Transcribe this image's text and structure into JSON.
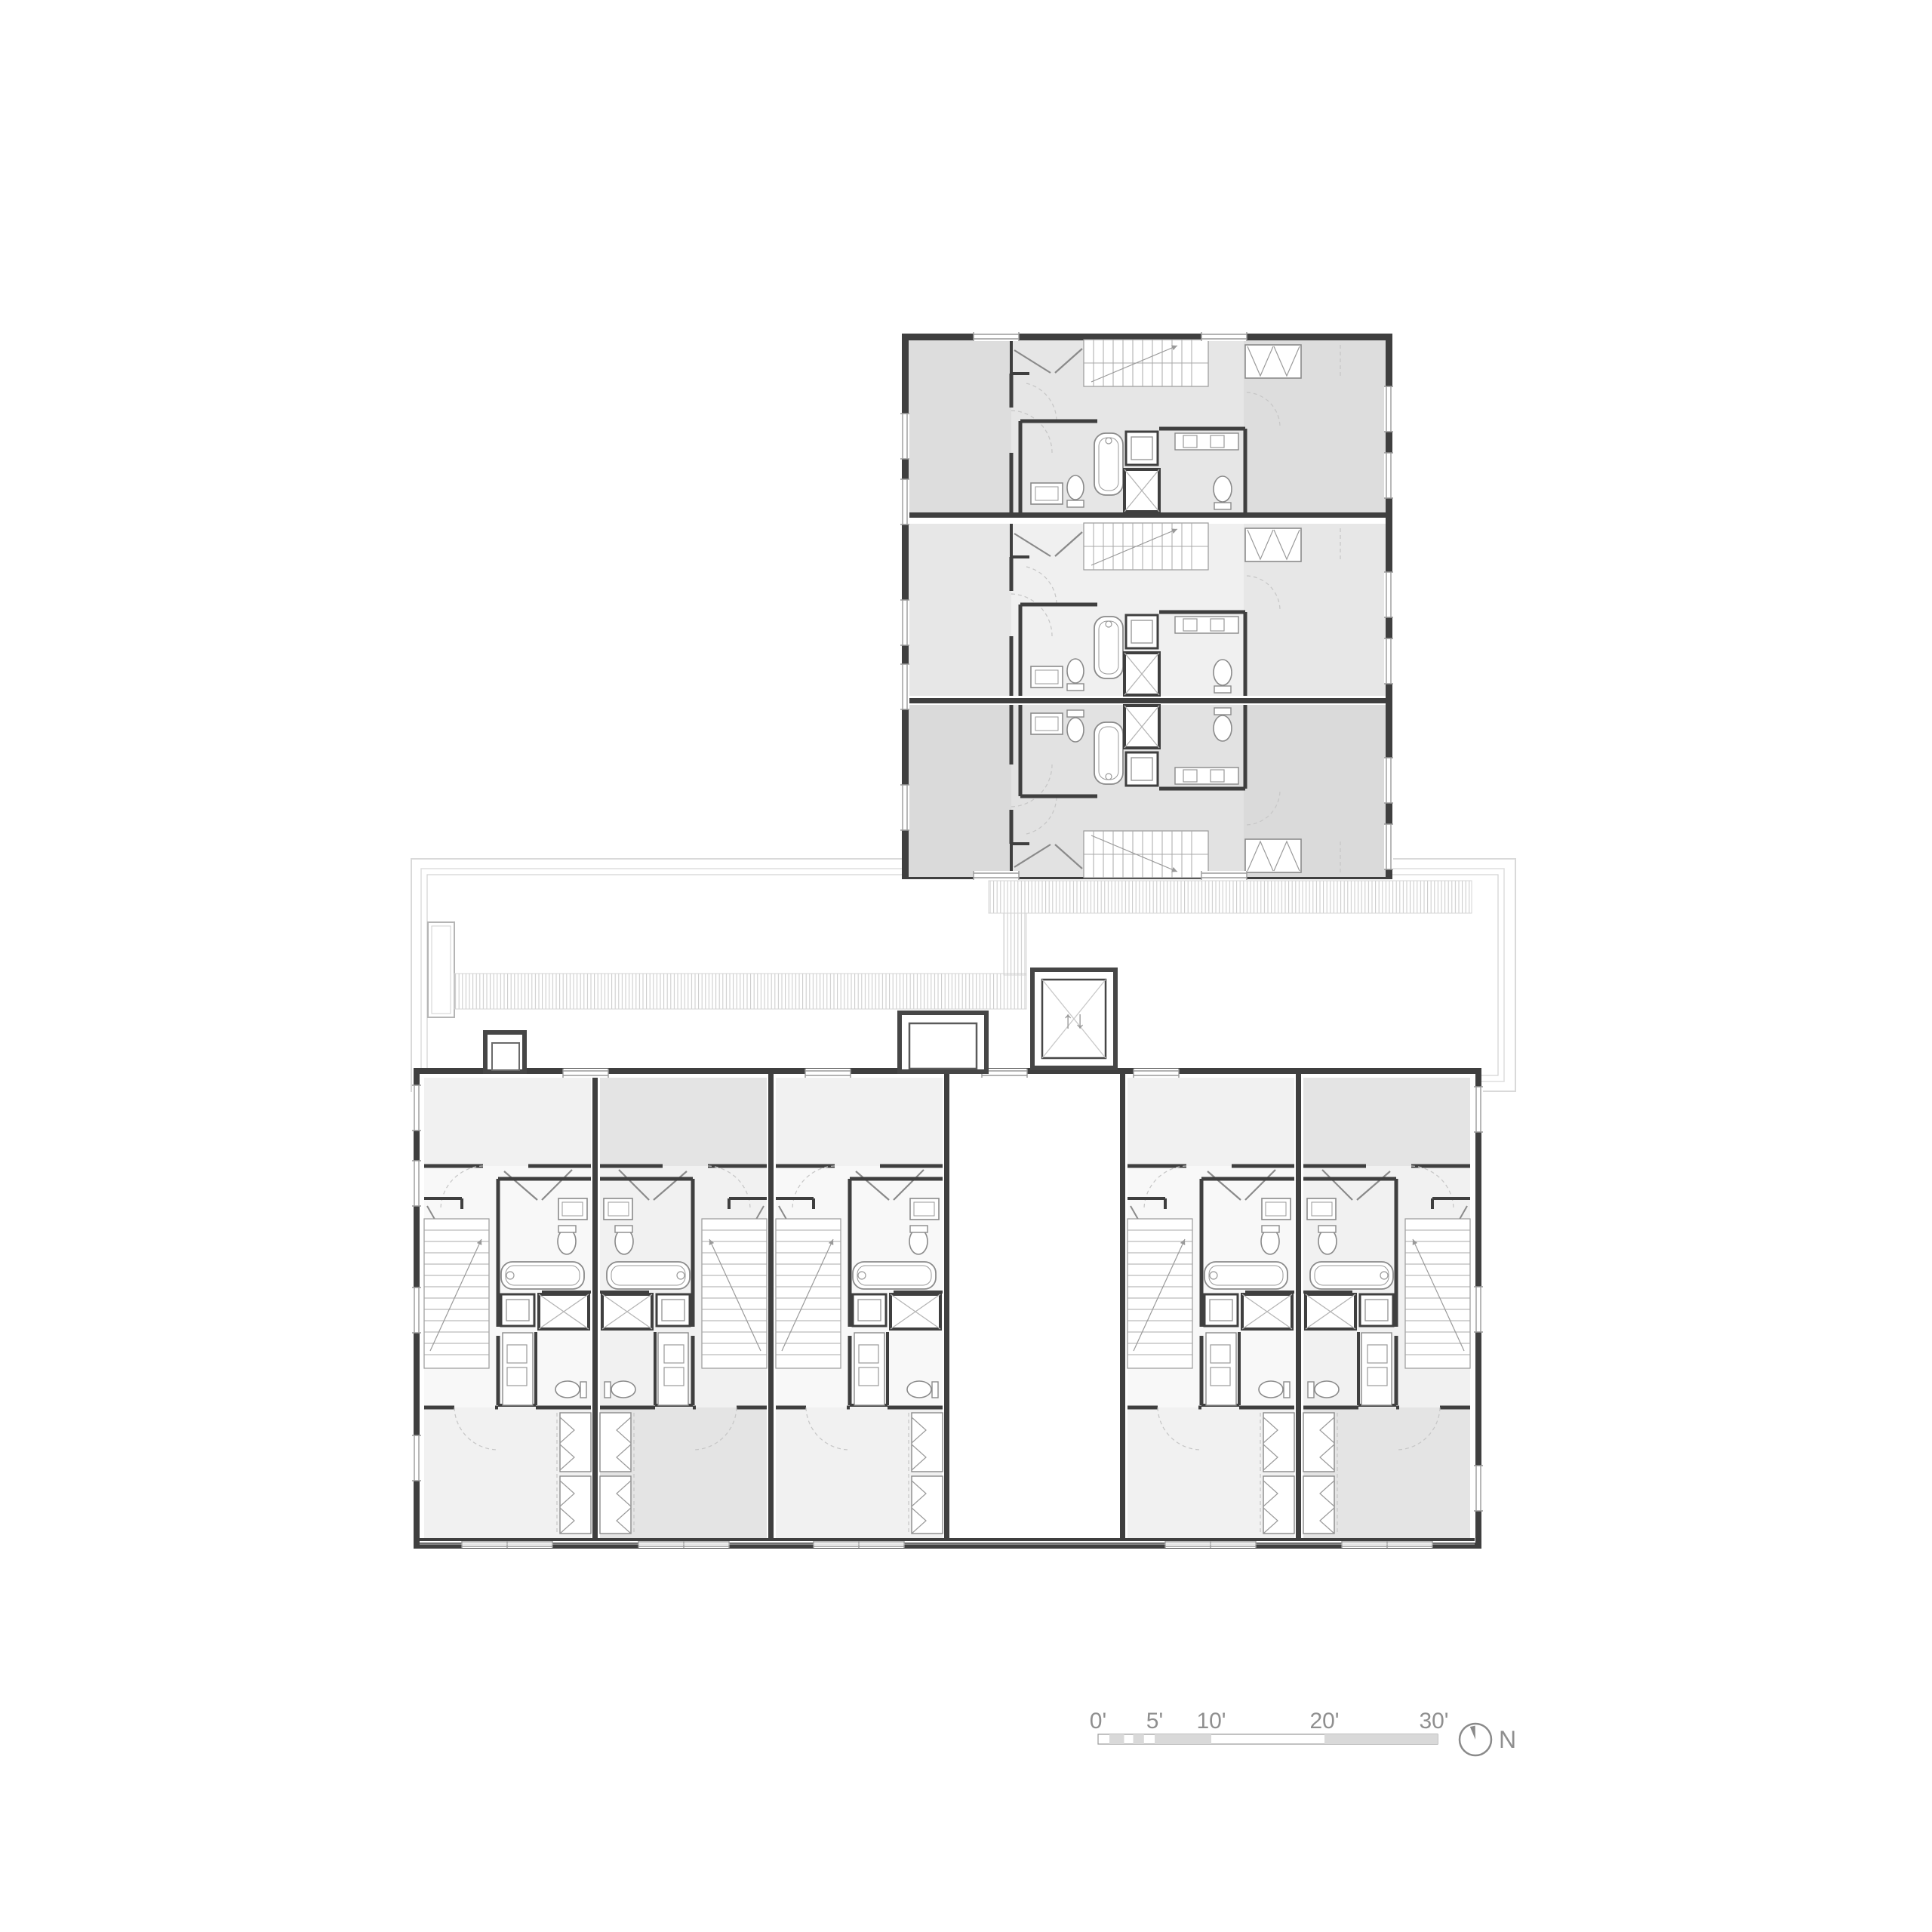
{
  "drawing": {
    "kind": "residential floor plan",
    "blocks": [
      "upper-flats-block",
      "roof-terrace",
      "lower-rowhouse-block"
    ]
  },
  "palette": {
    "wall": "#3f3f3f",
    "fixture_line": "#8a8a8a",
    "hatch_line": "#c9c9c9",
    "roof_outline": "#d9d9d9",
    "annotation_gray": "#8f8f8f",
    "scale_fill": "#d9d9d9"
  },
  "upper_block": {
    "unit_count": 3,
    "units": [
      {
        "id": "flat-1",
        "fill": "#e6e6e6"
      },
      {
        "id": "flat-2",
        "fill": "#f0f0f0"
      },
      {
        "id": "flat-3",
        "fill": "#e2e2e2"
      }
    ],
    "rooms_per_unit": [
      "bedroom",
      "entry-closet",
      "stair",
      "bathroom",
      "kitchen",
      "shaft",
      "bathroom-2",
      "bedroom-2",
      "wardrobe"
    ]
  },
  "lower_block": {
    "unit_count": 6,
    "units": [
      {
        "id": "rowhouse-1",
        "fill": "#f1f1f1"
      },
      {
        "id": "rowhouse-2",
        "fill": "#e4e4e4"
      },
      {
        "id": "rowhouse-3",
        "fill": "#f1f1f1"
      },
      {
        "id": "rowhouse-4",
        "fill": "#e4e4e4"
      },
      {
        "id": "rowhouse-5",
        "fill": "#f1f1f1"
      },
      {
        "id": "rowhouse-6",
        "fill": "#e4e4e4"
      }
    ],
    "rooms_per_unit": [
      "bedroom",
      "entry",
      "stair",
      "bathroom",
      "laundry-shaft",
      "vanity",
      "powder-room",
      "bedroom-2",
      "wardrobe"
    ]
  },
  "roof_terrace": {
    "features": [
      "parapet-outline",
      "planter",
      "slatted-walkway",
      "roof-bulkhead",
      "skylight",
      "elevator"
    ],
    "elevator_symbol": "↑↓"
  },
  "scale_bar": {
    "unit": "feet",
    "labels": [
      "0'",
      "5'",
      "10'",
      "20'",
      "30'"
    ],
    "tick_values_ft": [
      0,
      5,
      10,
      20,
      30
    ],
    "length_ft": 30,
    "shaded_segments_ft": [
      [
        1,
        2.3
      ],
      [
        3.1,
        4.05
      ],
      [
        5,
        10
      ],
      [
        20,
        30
      ]
    ]
  },
  "north_arrow": {
    "label": "N"
  }
}
